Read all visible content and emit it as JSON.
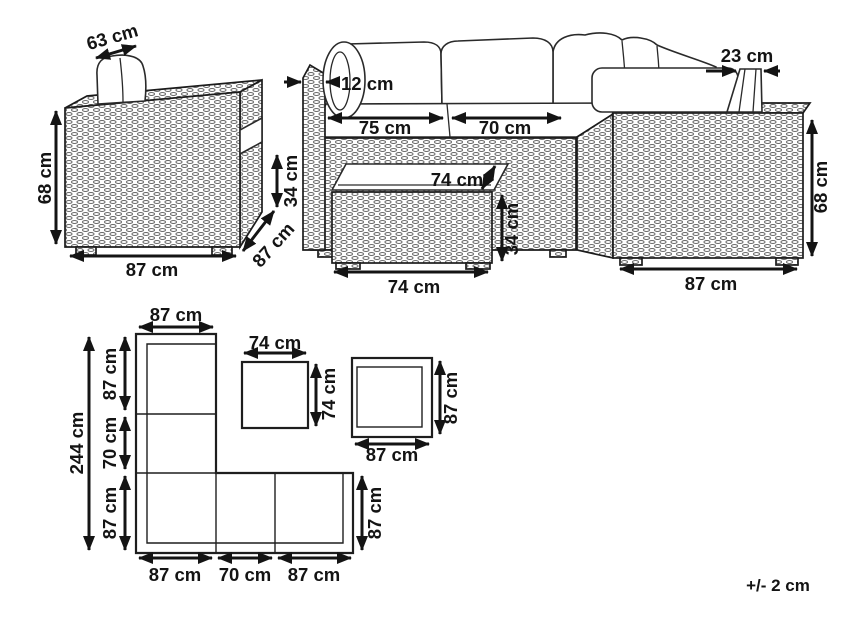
{
  "tolerance_note": "+/- 2 cm",
  "armchair": {
    "back_cushion_width": "63 cm",
    "height": "68 cm",
    "width": "87 cm",
    "depth": "87 cm",
    "armrest_height": "34 cm"
  },
  "corner_sofa": {
    "left_armrest_width": "12 cm",
    "seat_left_width": "75 cm",
    "seat_right_width": "70 cm",
    "right_armrest_width": "23 cm",
    "height": "68 cm",
    "end_width": "87 cm"
  },
  "coffee_table": {
    "depth": "74 cm",
    "height": "34 cm",
    "width": "74 cm"
  },
  "floor_plan": {
    "sofa_column_width": "87 cm",
    "sofa_total_length": "244 cm",
    "left_segments": [
      "87 cm",
      "70 cm",
      "87 cm"
    ],
    "bottom_segments": [
      "87 cm",
      "70 cm",
      "87 cm"
    ],
    "row_depth": "87 cm",
    "table_width": "74 cm",
    "table_depth": "74 cm",
    "armchair_width": "87 cm",
    "armchair_depth": "87 cm"
  }
}
